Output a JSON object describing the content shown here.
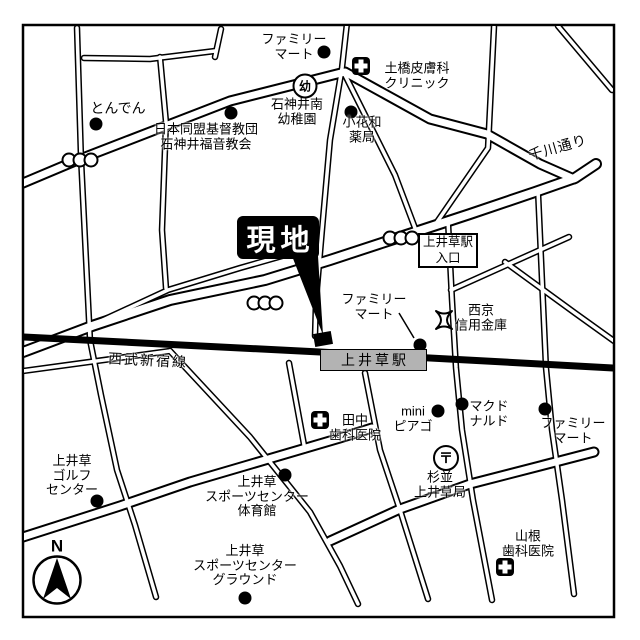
{
  "colors": {
    "ink": "#000000",
    "paper": "#ffffff",
    "station_fill": "#b3b3b3",
    "site_marker_bg": "#000000",
    "site_marker_text": "#ffffff"
  },
  "site_marker": {
    "label": "現地"
  },
  "station": {
    "name": "上井草駅",
    "entrance_label": "上井草駅\n入口",
    "line_label": "西武新宿線"
  },
  "roads": {
    "senkawa": "千川通り"
  },
  "compass": {
    "label": "N"
  },
  "badges": {
    "kindergarten": "幼",
    "post_office": "〒"
  },
  "places": {
    "familymart_north": "ファミリー\nマート",
    "dobashi_clinic": "土橋皮膚科\nクリニック",
    "tonden": "とんでん",
    "church": "日本同盟基督教団\n石神井福音教会",
    "kindergarten": "石神井南\n幼稚園",
    "obanawa_pharmacy": "小花和\n薬局",
    "familymart_station": "ファミリー\nマート",
    "seikyo_shinkin": "西京\n信用金庫",
    "tanaka_dental": "田中\n歯科医院",
    "mini_piago": "mini\nピアゴ",
    "mcdonalds": "マクド\nナルド",
    "suginami_post_office": "杉並\n上井草局",
    "familymart_south": "ファミリー\nマート",
    "yamane_dental": "山根\n歯科医院",
    "kamiigusa_golf": "上井草\nゴルフ\nセンター",
    "sports_gym": "上井草\nスポーツセンター\n体育館",
    "sports_ground": "上井草\nスポーツセンター\nグラウンド"
  }
}
